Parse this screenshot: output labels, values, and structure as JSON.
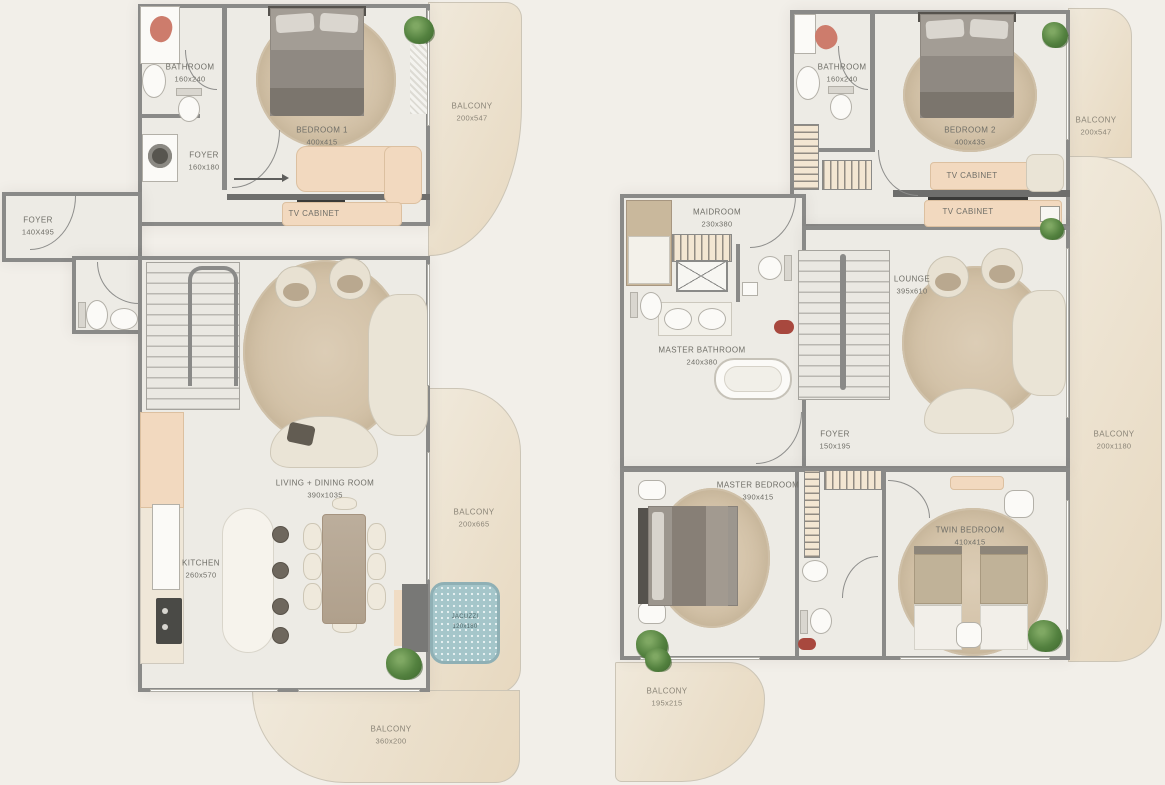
{
  "meta": {
    "type": "residential duplex floor plans, two levels side by side"
  },
  "colors": {
    "background": "#f2efe9",
    "floor": "#edebe5",
    "wall": "#8a8a88",
    "balcony": "#e8dac2",
    "label_text": "#6f6e67",
    "furniture_peach": "#f2d9bf",
    "furniture_cream": "#eae4d6",
    "rug": "#d3c2a8",
    "jacuzzi": "#a5c6ca",
    "plant": "#53813f"
  },
  "left_plan": {
    "labels": {
      "bathroom": {
        "name": "BATHROOM",
        "dims": "160x240"
      },
      "bedroom1": {
        "name": "BEDROOM 1",
        "dims": "400x415"
      },
      "foyer_small": {
        "name": "FOYER",
        "dims": "160x180"
      },
      "foyer_left": {
        "name": "FOYER",
        "dims": "140X495"
      },
      "tv_cabinet": {
        "name": "TV CABINET",
        "dims": ""
      },
      "living_dining": {
        "name": "LIVING + DINING ROOM",
        "dims": "390x1035"
      },
      "kitchen": {
        "name": "KITCHEN",
        "dims": "260x570"
      },
      "jacuzzi": {
        "name": "JACUZZI",
        "dims": "120x180"
      },
      "balcony_top": {
        "name": "BALCONY",
        "dims": "200x547"
      },
      "balcony_right": {
        "name": "BALCONY",
        "dims": "200x665"
      },
      "balcony_bottom": {
        "name": "BALCONY",
        "dims": "360x200"
      }
    }
  },
  "right_plan": {
    "labels": {
      "bathroom": {
        "name": "BATHROOM",
        "dims": "160x240"
      },
      "bedroom2": {
        "name": "BEDROOM 2",
        "dims": "400x435"
      },
      "tv_cabinet_1": {
        "name": "TV CABINET",
        "dims": ""
      },
      "tv_cabinet_2": {
        "name": "TV CABINET",
        "dims": ""
      },
      "maidroom": {
        "name": "MAIDROOM",
        "dims": "230x380"
      },
      "lounge": {
        "name": "LOUNGE",
        "dims": "395x610"
      },
      "master_bathroom": {
        "name": "MASTER BATHROOM",
        "dims": "240x380"
      },
      "foyer": {
        "name": "FOYER",
        "dims": "150x195"
      },
      "master_bedroom": {
        "name": "MASTER BEDROOM",
        "dims": "390x415"
      },
      "twin_bedroom": {
        "name": "TWIN BEDROOM",
        "dims": "410x415"
      },
      "balcony_top": {
        "name": "BALCONY",
        "dims": "200x547"
      },
      "balcony_right": {
        "name": "BALCONY",
        "dims": "200x1180"
      },
      "balcony_bottom": {
        "name": "BALCONY",
        "dims": "195x215"
      }
    }
  }
}
